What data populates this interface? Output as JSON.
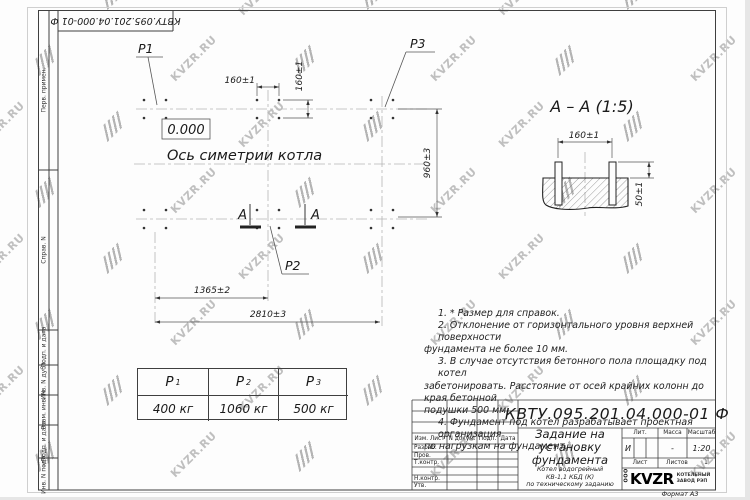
{
  "watermark": {
    "text": "KVZR.RU"
  },
  "frame": {
    "top_stamp": "КВТУ.095.201.04.000-01 Ф",
    "format_label": "Формат А3",
    "left_labels": [
      {
        "label": "Перв. примен."
      },
      {
        "label": "Справ. N"
      },
      {
        "label": "Подп. и дата"
      },
      {
        "label": "Инв. N дубл."
      },
      {
        "label": "Взам. инв. N"
      },
      {
        "label": "Подп. и дата"
      },
      {
        "label": "Инв. N подл."
      }
    ]
  },
  "plan": {
    "level_mark": "0.000",
    "axis_label": "Ось симетрии котла",
    "load_p1": "P1",
    "load_p2": "P2",
    "load_p3": "P3",
    "section_letter_left": "А",
    "section_letter_right": "А",
    "dim_top_horizontal": "160±1",
    "dim_top_vertical": "160±1",
    "dim_right_vertical": "960±3",
    "dim_bottom_inner": "1365±2",
    "dim_bottom_outer": "2810±3"
  },
  "section": {
    "title": "А – А  (1:5)",
    "dim_width": "160±1",
    "dim_height": "50±1"
  },
  "notes": {
    "lines": [
      "1.  * Размер для справок.",
      "2.  Отклонение от горизонтального уровня верхней поверхности",
      "фундамента не более 10 мм.",
      "3.  В случае отсутствия бетонного пола площадку под котел",
      "забетонировать. Расстояние от осей крайних колонн до края бетонной",
      "подушки 500 мм.",
      "4.  Фундамент под котел разрабатывает проектная организация",
      "по нагрузкам на фундамент."
    ]
  },
  "load_table": {
    "headers": [
      {
        "sym": "P",
        "sub": "1"
      },
      {
        "sym": "P",
        "sub": "2"
      },
      {
        "sym": "P",
        "sub": "3"
      }
    ],
    "values": [
      "400 кг",
      "1060 кг",
      "500 кг"
    ]
  },
  "title_block": {
    "doc_number": "КВТУ.095.201.04.000-01 Ф",
    "col_izm_list": "Изм. Лист",
    "col_doc": "N докум.",
    "col_sign": "Подп.",
    "col_date": "Дата",
    "row_razrab": "Разраб.",
    "row_prov": "Пров.",
    "row_tkontr": "Т.контр.",
    "row_nkontr": "Н.контр.",
    "row_utv": "Утв.",
    "title_line1": "Задание на",
    "title_line2": "установку",
    "title_line3": "фундамента",
    "subtitle_line1": "Котел водогрейный",
    "subtitle_line2": "КВ-1,1 КБД (К)",
    "subtitle_line3": "по техническому заданию",
    "lit_header": "Лит.",
    "mass_header": "Масса",
    "scale_header": "Масштаб",
    "lit_value": "И",
    "mass_value": "-",
    "scale_value": "1:20",
    "sheet_label": "Лист",
    "sheets_label": "Листов",
    "sheets_value": "1",
    "logo_ooo": "ООО",
    "logo_name": "KVZR",
    "logo_desc1": "КОТЕЛЬНЫЙ",
    "logo_desc2": "ЗАВОД РЭП"
  }
}
